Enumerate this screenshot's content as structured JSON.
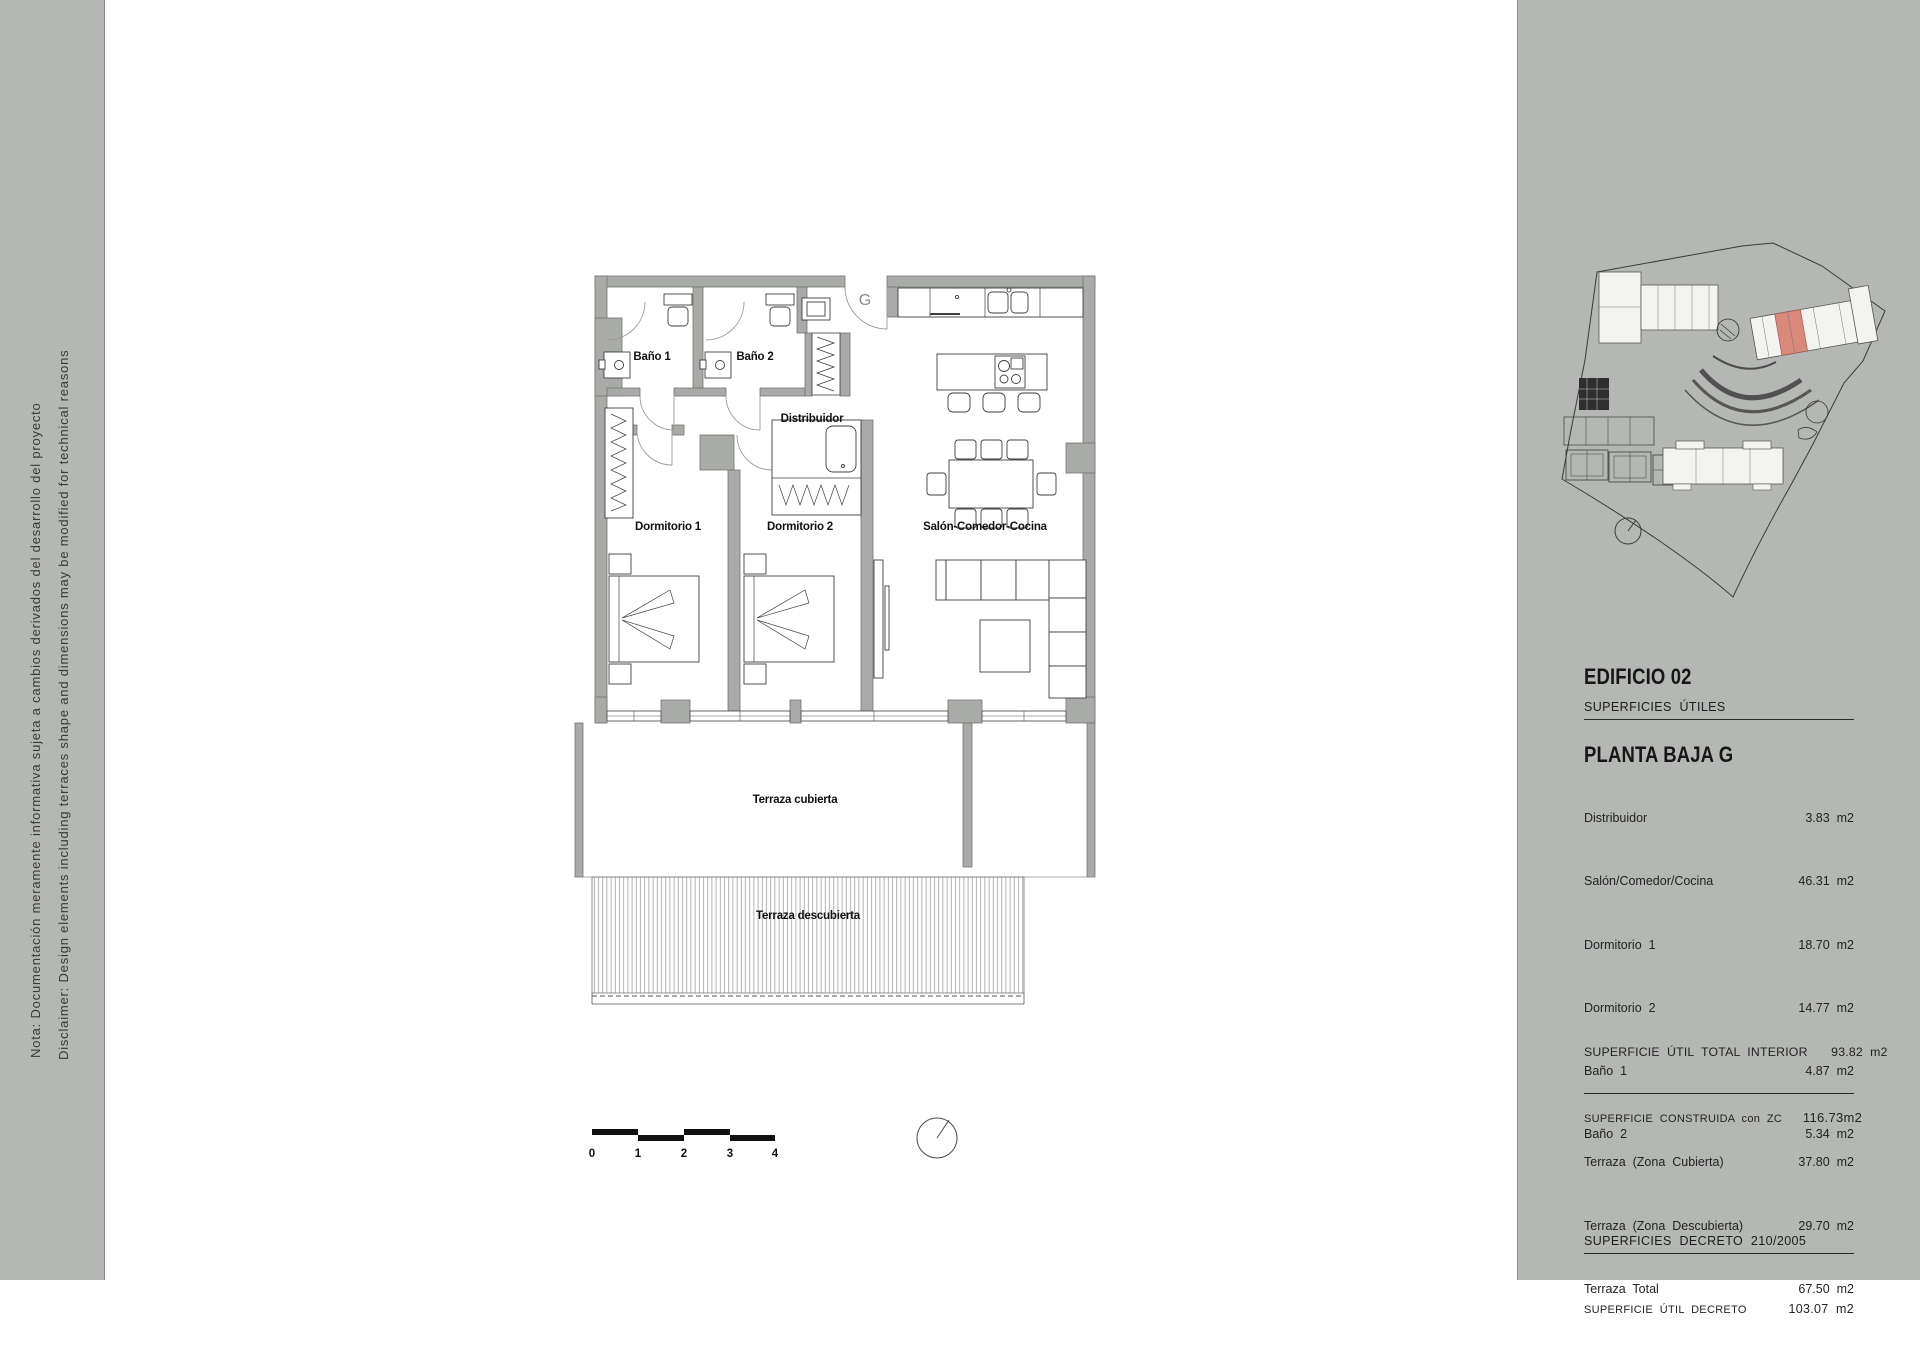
{
  "colors": {
    "panel_bg": "#b4b7b3",
    "wall_grey": "#a8aba7",
    "highlight_unit": "#d8897a",
    "line": "#3f3f3f"
  },
  "disclaimer": {
    "line1": "Nota: Documentación meramente informativa sujeta a cambios derivados del desarrollo del proyecto",
    "line2": "Disclaimer: Design elements including terraces shape and dimensions may be modified for technical reasons"
  },
  "plan": {
    "entrance_label": "G",
    "rooms": {
      "bano1": "Baño 1",
      "bano2": "Baño 2",
      "distribuidor": "Distribuidor",
      "dormitorio1": "Dormitorio 1",
      "dormitorio2": "Dormitorio 2",
      "salon": "Salón-Comedor-Cocina",
      "terraza_cubierta": "Terraza cubierta",
      "terraza_descubierta": "Terraza descubierta"
    },
    "scale_ticks": [
      "0",
      "1",
      "2",
      "3",
      "4"
    ]
  },
  "panel": {
    "title": "EDIFICIO 02",
    "subtitle": "PLANTA BAJA G",
    "utiles": {
      "heading": "SUPERFICIES  ÚTILES",
      "rows": [
        {
          "label": "Distribuidor",
          "value": "3.83  m2"
        },
        {
          "label": "Salón/Comedor/Cocina",
          "value": "46.31  m2"
        },
        {
          "label": "Dormitorio  1",
          "value": "18.70  m2"
        },
        {
          "label": "Dormitorio  2",
          "value": "14.77  m2"
        },
        {
          "label": "Baño  1",
          "value": "4.87  m2"
        },
        {
          "label": "Baño  2",
          "value": "5.34  m2"
        }
      ]
    },
    "total": {
      "label": "SUPERFICIE  ÚTIL  TOTAL  INTERIOR",
      "value": "93.82  m2"
    },
    "construida": {
      "label": "SUPERFICIE  CONSTRUIDA  con  ZC",
      "value": "116.73m2"
    },
    "terrazas": {
      "rows": [
        {
          "label": "Terraza  (Zona  Cubierta)",
          "value": "37.80  m2"
        },
        {
          "label": "Terraza  (Zona  Descubierta)",
          "value": "29.70  m2"
        },
        {
          "label": "Terraza  Total",
          "value": "67.50  m2"
        }
      ]
    },
    "decreto": {
      "heading": "SUPERFICIES  DECRETO  210/2005",
      "rows": [
        {
          "label": "SUPERFICIE  ÚTIL  DECRETO",
          "value": "103.07  m2"
        }
      ]
    }
  }
}
